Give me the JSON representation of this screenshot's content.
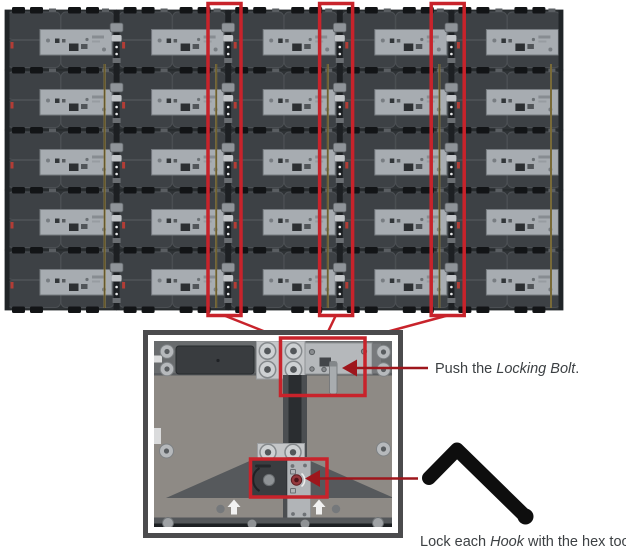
{
  "page": {
    "background": "#ffffff"
  },
  "colors": {
    "annotation_red": "#c8232b",
    "arrow_red": "#9e161c",
    "text": "#3c4043",
    "hex_tool_black": "#0e0e0e",
    "cabinet_dark": "#2e3235",
    "cabinet_panel": "#3d4145",
    "plate_gray": "#a7acb1",
    "cable_tan": "#8c7c46"
  },
  "wall_figure": {
    "name": "led-wall-rear-view",
    "columns": 5,
    "rows": 5,
    "highlighted_seams": [
      2,
      3,
      4
    ]
  },
  "detail_figure": {
    "name": "panel-joint-detail"
  },
  "callouts": [
    {
      "prefix": "Push the ",
      "italic": "Locking Bolt",
      "suffix": "."
    },
    {
      "prefix": "Lock each ",
      "italic": "Hook",
      "suffix": " with the hex tool."
    }
  ],
  "icons": {
    "hex_tool": "hex-key-icon",
    "up_arrow": "up-arrow-icon",
    "locking_bolt_arrow": "left-arrow-icon",
    "hook_arrow": "left-arrow-icon"
  }
}
